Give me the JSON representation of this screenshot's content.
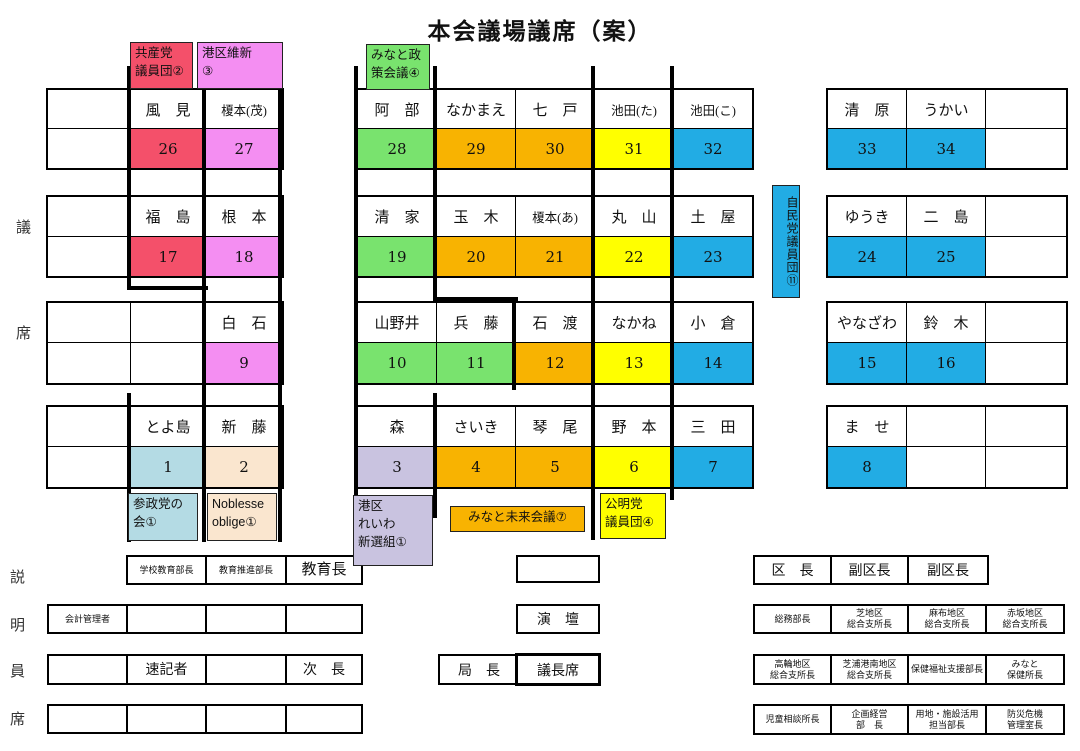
{
  "title": "本会議場議席（案）",
  "side_labels": {
    "upper": "議席",
    "lower": "説明員席"
  },
  "colors": {
    "red": "#f4506a",
    "pink": "#f48ef2",
    "green": "#79e36e",
    "orange": "#f8b301",
    "yellow": "#ffff00",
    "blue": "#22ace4",
    "lightblue": "#b4dbe4",
    "cream": "#fae6cf",
    "lavender": "#c9c3e0"
  },
  "party_labels": [
    {
      "id": "kyosanto",
      "text": "共産党\n議員団②",
      "color": "red"
    },
    {
      "id": "minatoku-ishin",
      "text": "港区維新\n③",
      "color": "pink"
    },
    {
      "id": "minato-seisaku",
      "text": "みなと政\n策会議④",
      "color": "green"
    },
    {
      "id": "jiminto",
      "text": "自民党議員団⑪",
      "color": "blue"
    },
    {
      "id": "sanseito",
      "text": "参政党の\n会①",
      "color": "lightblue"
    },
    {
      "id": "noblesse",
      "text": "Noblesse\noblige①",
      "color": "cream"
    },
    {
      "id": "reiwa",
      "text": "港区\nれいわ\n新選組①",
      "color": "lavender"
    },
    {
      "id": "minato-mirai",
      "text": "みなと未来会議⑦",
      "color": "orange"
    },
    {
      "id": "komeito",
      "text": "公明党\n議員団④",
      "color": "yellow"
    }
  ],
  "seat_rows": [
    {
      "left": [
        null,
        {
          "n": "風　見",
          "s": "26",
          "c": "red"
        },
        {
          "n": "榎本(茂)",
          "s": "27",
          "c": "pink"
        }
      ],
      "mid": [
        {
          "n": "阿　部",
          "s": "28",
          "c": "green"
        },
        {
          "n": "なかまえ",
          "s": "29",
          "c": "orange"
        },
        {
          "n": "七　戸",
          "s": "30",
          "c": "orange"
        },
        {
          "n": "池田(た)",
          "s": "31",
          "c": "yellow"
        },
        {
          "n": "池田(こ)",
          "s": "32",
          "c": "blue"
        }
      ],
      "right": [
        {
          "n": "清　原",
          "s": "33",
          "c": "blue"
        },
        {
          "n": "うかい",
          "s": "34",
          "c": "blue"
        },
        null
      ]
    },
    {
      "left": [
        null,
        {
          "n": "福　島",
          "s": "17",
          "c": "red"
        },
        {
          "n": "根　本",
          "s": "18",
          "c": "pink"
        }
      ],
      "mid": [
        {
          "n": "清　家",
          "s": "19",
          "c": "green"
        },
        {
          "n": "玉　木",
          "s": "20",
          "c": "orange"
        },
        {
          "n": "榎本(あ)",
          "s": "21",
          "c": "orange"
        },
        {
          "n": "丸　山",
          "s": "22",
          "c": "yellow"
        },
        {
          "n": "土　屋",
          "s": "23",
          "c": "blue"
        }
      ],
      "right": [
        {
          "n": "ゆうき",
          "s": "24",
          "c": "blue"
        },
        {
          "n": "二　島",
          "s": "25",
          "c": "blue"
        },
        null
      ]
    },
    {
      "left": [
        null,
        null,
        {
          "n": "白　石",
          "s": "9",
          "c": "pink"
        }
      ],
      "mid": [
        {
          "n": "山野井",
          "s": "10",
          "c": "green"
        },
        {
          "n": "兵　藤",
          "s": "11",
          "c": "green"
        },
        {
          "n": "石　渡",
          "s": "12",
          "c": "orange"
        },
        {
          "n": "なかね",
          "s": "13",
          "c": "yellow"
        },
        {
          "n": "小　倉",
          "s": "14",
          "c": "blue"
        }
      ],
      "right": [
        {
          "n": "やなざわ",
          "s": "15",
          "c": "blue"
        },
        {
          "n": "鈴　木",
          "s": "16",
          "c": "blue"
        },
        null
      ]
    },
    {
      "left": [
        null,
        {
          "n": "とよ島",
          "s": "1",
          "c": "lightblue"
        },
        {
          "n": "新　藤",
          "s": "2",
          "c": "cream"
        }
      ],
      "mid": [
        {
          "n": "森",
          "s": "3",
          "c": "lavender"
        },
        {
          "n": "さいき",
          "s": "4",
          "c": "orange"
        },
        {
          "n": "琴　尾",
          "s": "5",
          "c": "orange"
        },
        {
          "n": "野　本",
          "s": "6",
          "c": "yellow"
        },
        {
          "n": "三　田",
          "s": "7",
          "c": "blue"
        }
      ],
      "right": [
        {
          "n": "ま　せ",
          "s": "8",
          "c": "blue"
        },
        null,
        null
      ]
    }
  ],
  "officials_left": [
    [
      {
        "t": "学校教育部長",
        "sz": "xs"
      },
      {
        "t": "教育推進部長",
        "sz": "xs"
      },
      {
        "t": "教育長",
        "sz": "lg"
      }
    ],
    [
      {
        "t": "会計管理者",
        "sz": "xs"
      },
      {
        "t": ""
      },
      {
        "t": ""
      },
      {
        "t": ""
      }
    ],
    [
      {
        "t": ""
      },
      {
        "t": "速記者",
        "sz": "md"
      },
      {
        "t": ""
      },
      {
        "t": "次　長",
        "sz": "md"
      }
    ],
    [
      {
        "t": ""
      },
      {
        "t": ""
      },
      {
        "t": ""
      },
      {
        "t": ""
      }
    ]
  ],
  "podium_area": {
    "upper_box": "",
    "endan": "演　壇",
    "kyokucho": "局　長",
    "gichoseki": "議長席"
  },
  "officials_right": [
    [
      {
        "t": "区　長",
        "sz": "md"
      },
      {
        "t": "副区長",
        "sz": "md"
      },
      {
        "t": "副区長",
        "sz": "md"
      }
    ],
    [
      {
        "t": "総務部長",
        "sz": "xs"
      },
      {
        "t": "芝地区\n総合支所長",
        "sz": "xs"
      },
      {
        "t": "麻布地区\n総合支所長",
        "sz": "xs"
      },
      {
        "t": "赤坂地区\n総合支所長",
        "sz": "xs"
      }
    ],
    [
      {
        "t": "高輪地区\n総合支所長",
        "sz": "xs"
      },
      {
        "t": "芝浦港南地区\n総合支所長",
        "sz": "xs"
      },
      {
        "t": "保健福祉支援部長",
        "sz": "xs"
      },
      {
        "t": "みなと\n保健所長",
        "sz": "xs"
      }
    ],
    [
      {
        "t": "児童相談所長",
        "sz": "xs"
      },
      {
        "t": "企画経営\n部　長",
        "sz": "xs"
      },
      {
        "t": "用地・施設活用\n担当部長",
        "sz": "xs"
      },
      {
        "t": "防災危機\n管理室長",
        "sz": "xs"
      }
    ]
  ]
}
